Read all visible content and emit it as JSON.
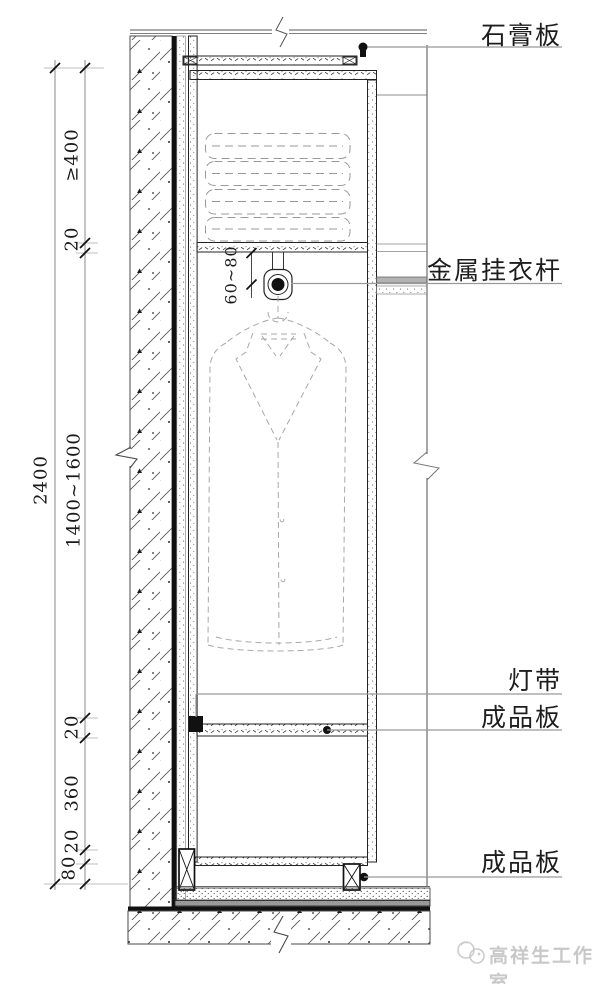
{
  "drawing": {
    "labels": {
      "gypsum_board": "石膏板",
      "metal_hanging_rod": "金属挂衣杆",
      "light_strip": "灯带",
      "finished_panel": "成品板",
      "finished_panel_base": "成品板"
    },
    "dimensions": {
      "total_height": "2400",
      "min_top_space": "≥400",
      "panel_20_top": "20",
      "hanging_zone": "1400~1600",
      "panel_20_mid": "20",
      "lower_space": "360",
      "panel_20_base": "20",
      "plinth_80": "80",
      "rod_drop": "60~80"
    },
    "watermark": {
      "studio_name": "高祥生工作室"
    }
  }
}
